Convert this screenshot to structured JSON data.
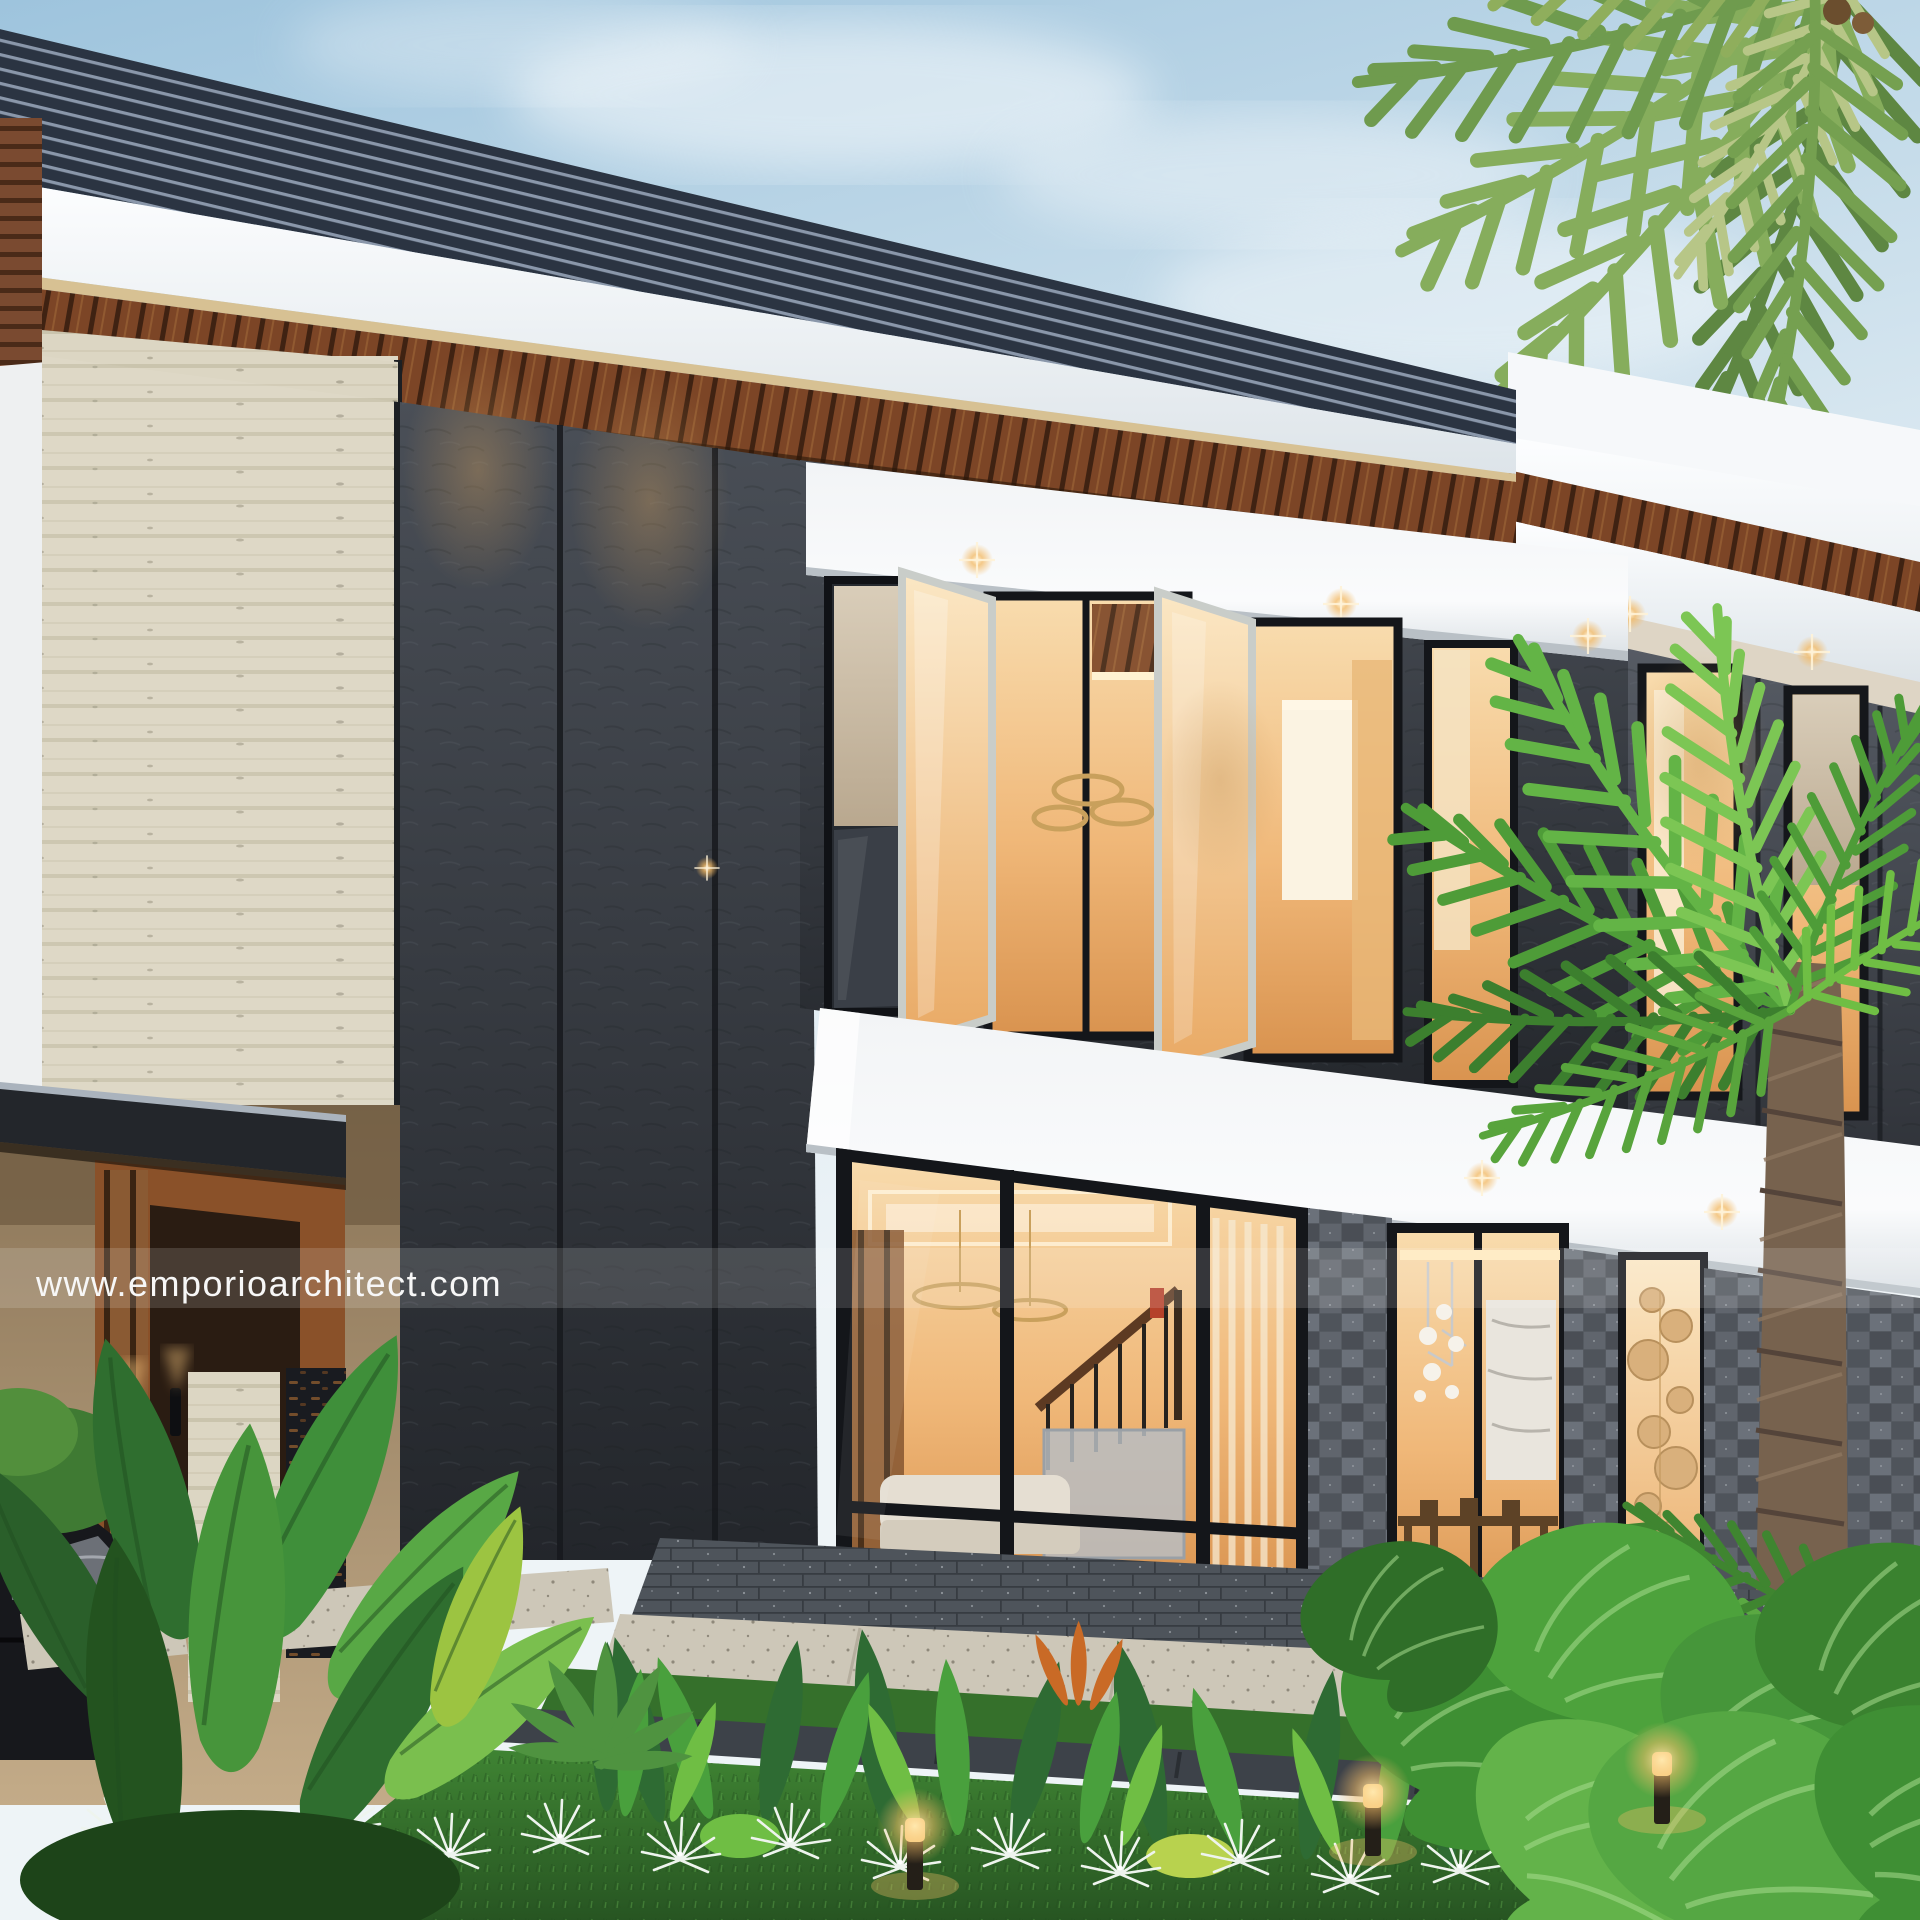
{
  "watermark": {
    "text": "www.emporioarchitect.com",
    "color": "#f7f7f7",
    "band_color": "#ffffff"
  },
  "scene": {
    "subject": "modern-two-story-villa-exterior-dusk",
    "colors": {
      "sky_top": "#9ec4dd",
      "sky_horizon": "#eef4f7",
      "roof_slat_dark": "#2b3442",
      "roof_slat_light": "#8a97aa",
      "fascia_white": "#f4f6f8",
      "soffit_wood": "#7c4526",
      "soffit_wood_dark": "#3f2212",
      "travertine": "#dcd6c3",
      "wall_charcoal_top": "#4a4f57",
      "wall_charcoal_bottom": "#23262b",
      "band_white": "#f2f4f6",
      "glass_warm_top": "#f8dcae",
      "glass_warm_bottom": "#d9934f",
      "lava_stone": "#555a61",
      "plinth_stone": "#4e545b",
      "path_stone": "#cdc7b8",
      "grass": "#3f8433",
      "foliage_dark": "#2e6b33",
      "foliage_bright": "#6fbe44",
      "flower_white": "#eef4ee",
      "palm_green": "#86ad5c",
      "trunk_brown": "#77624e",
      "car_black": "#17181c",
      "warm_light": "#f6c98c"
    }
  }
}
